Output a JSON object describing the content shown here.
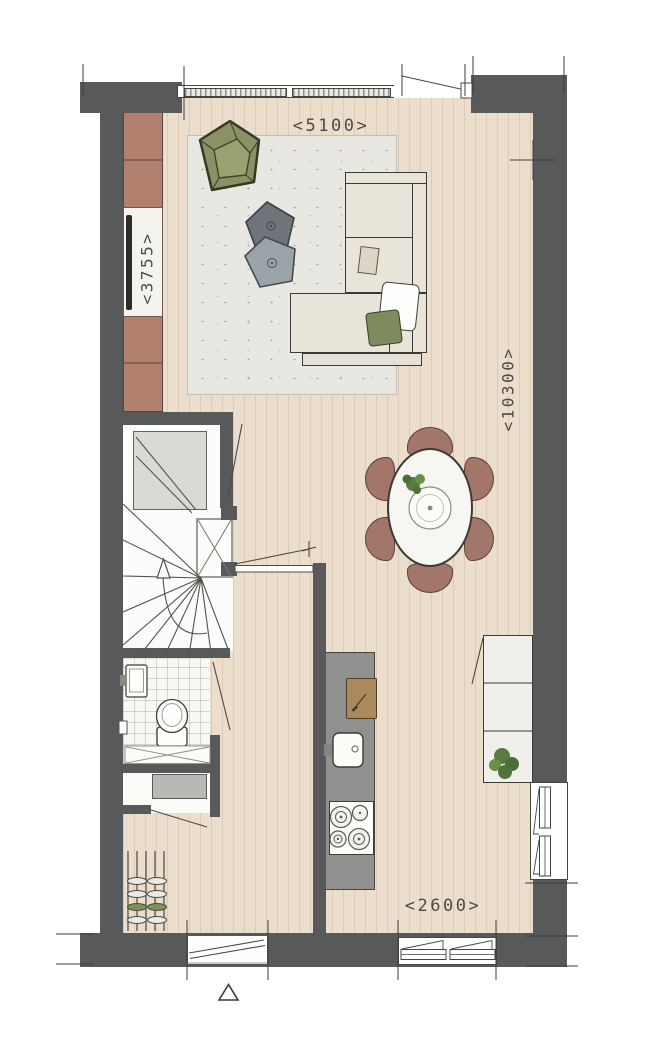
{
  "plan": {
    "dimension_labels": {
      "top": "<5100>",
      "left": "<3755>",
      "right": "<10300>",
      "bottom": "<2600>"
    },
    "palette": {
      "wall": "#58595b",
      "wood_floor": "#ecdecd",
      "rug": "#e9e7e1",
      "cabinet_brown": "#b2806f",
      "sofa_cream": "#e9e4da",
      "armchair_green": "#8a9164",
      "pillow_green": "#7d8b5e",
      "dining_chair_brown": "#a3766a",
      "kitchen_counter_gray": "#90908e",
      "cutting_board_wood": "#ab8a5e",
      "plant_green": "#587c41",
      "appliance_gray": "#b9b8b4"
    },
    "rooms": [
      "living-room",
      "dining-area",
      "kitchen",
      "hallway",
      "staircase",
      "toilet",
      "storage-closet"
    ],
    "furniture": [
      "wall-cabinet-with-tv",
      "green-armchair",
      "two-pentagon-side-tables",
      "area-rug",
      "corner-sofa-with-pillows",
      "oval-dining-table-six-chairs",
      "kitchen-counter-with-sink-and-cooktop",
      "cutting-board-with-knife",
      "sideboard-with-plant",
      "toilet",
      "hand-basin",
      "washer-appliance",
      "shoe-rack-with-shoes"
    ],
    "symbols": [
      "door-swing-arcs",
      "window-opening-triangles",
      "winder-stair-treads",
      "stair-up-arrow",
      "duct-shaft-x",
      "crawl-space-hatch-x",
      "entrance-triangle-marker",
      "dimension-tick-marks"
    ]
  }
}
